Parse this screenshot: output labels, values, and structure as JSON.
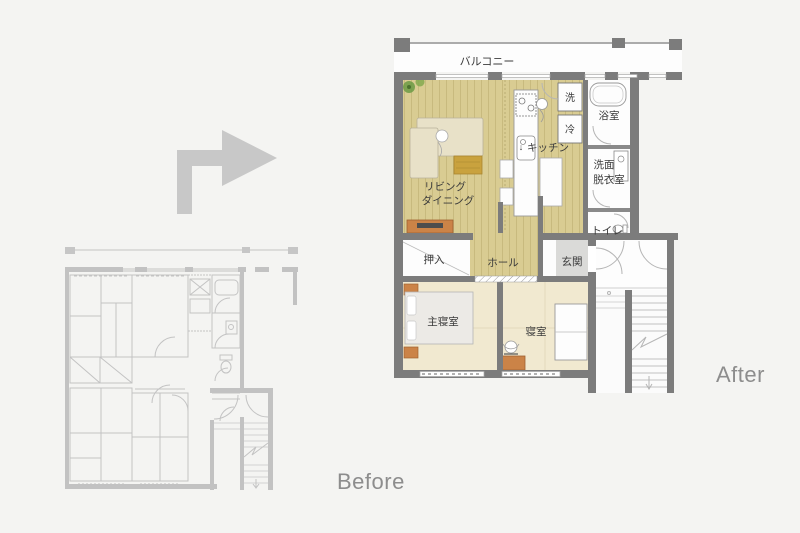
{
  "captions": {
    "before": "Before",
    "after": "After"
  },
  "after_plan": {
    "rooms": {
      "balcony": "バルコニー",
      "living_line1": "リビング",
      "living_line2": "ダイニング",
      "kitchen": "キッチン",
      "kitchen_arrow": "↓",
      "washer": "洗",
      "fridge": "冷",
      "bath": "浴室",
      "washroom_line1": "洗面",
      "washroom_line2": "脱衣室",
      "toilet": "トイレ",
      "closet": "押入",
      "hall": "ホール",
      "entrance": "玄関",
      "master_bedroom": "主寝室",
      "bedroom": "寝室"
    }
  },
  "colors": {
    "background": "#f4f4f2",
    "wall": "#7c7c7c",
    "wood_floor": "#d9cc92",
    "wood_plank_line": "#c6b87c",
    "bedroom_floor": "#f1e9d0",
    "sofa": "#e8e1c8",
    "low_table": "#c9a23e",
    "furniture_orange": "#cb8347",
    "entrance_tile": "#dadad8",
    "bed": "#eceae6",
    "plant_green": "#6b9a44",
    "before_line_gray": "#c3c3c3",
    "caption_text": "#8d8d8d",
    "arrow_gray": "#c8c8c8",
    "label_text": "#3b3b3b"
  }
}
